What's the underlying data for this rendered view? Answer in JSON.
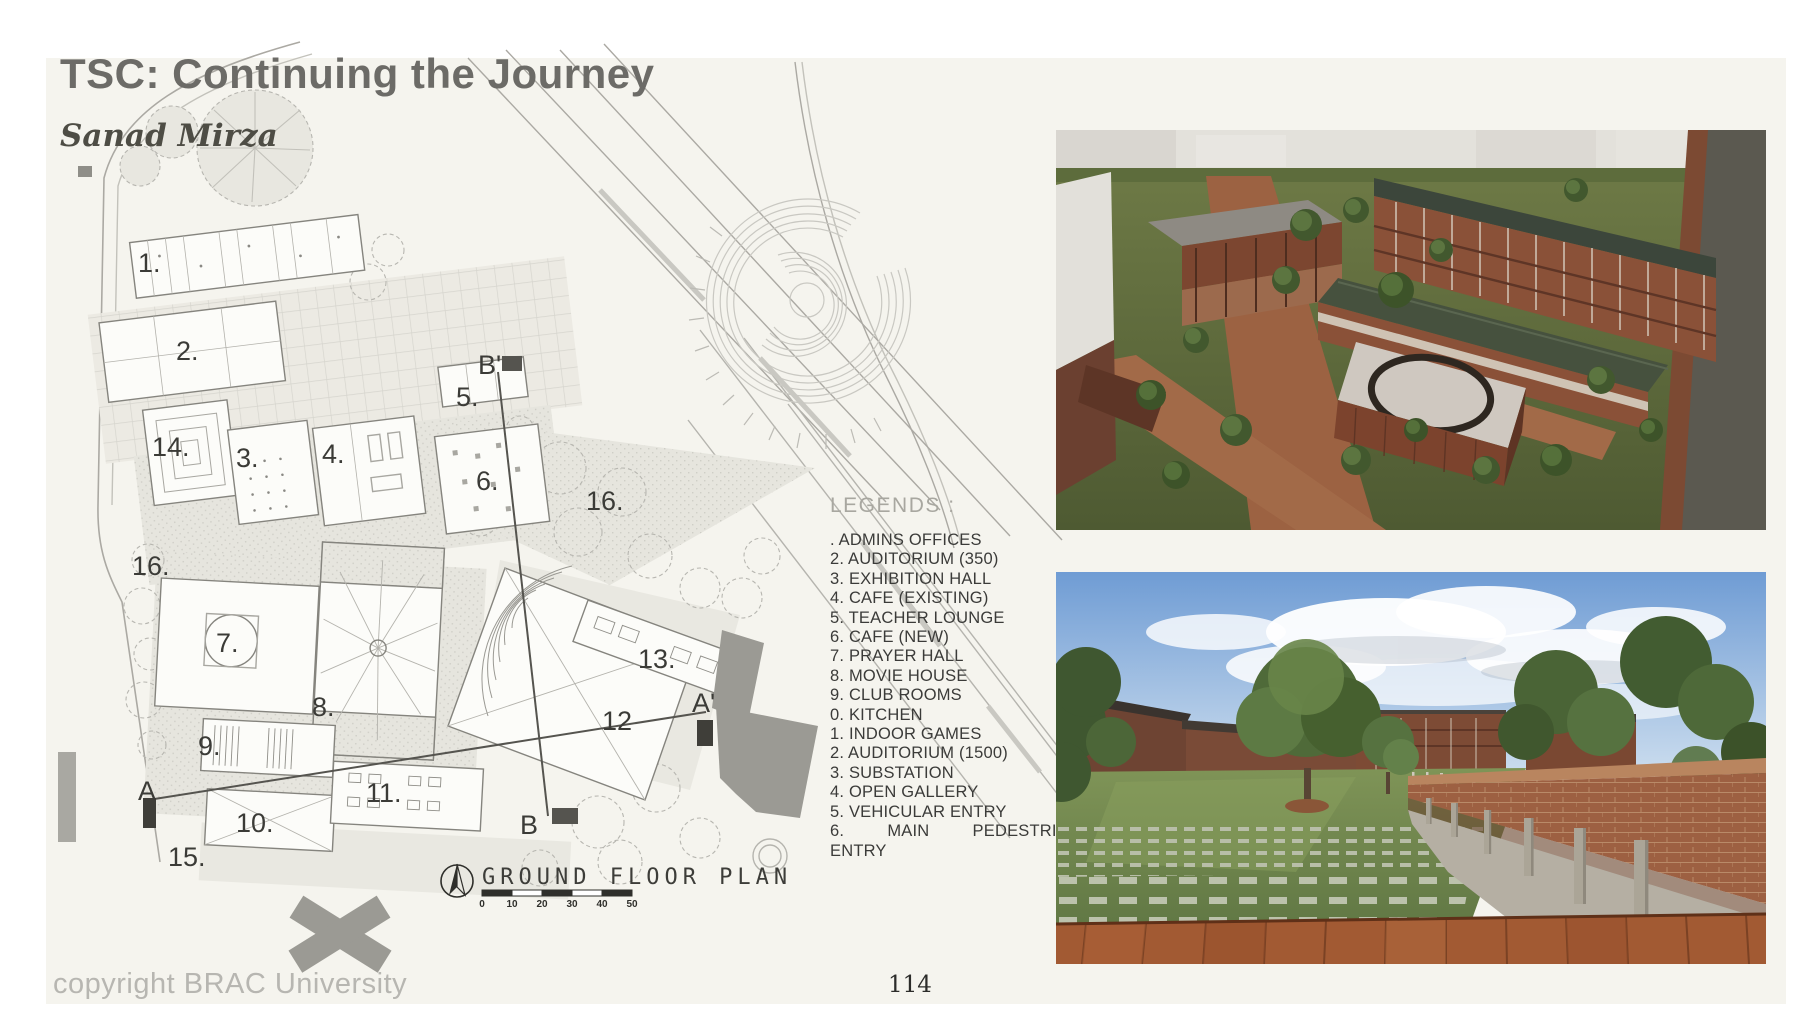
{
  "header": {
    "title": "TSC: Continuing the Journey",
    "subtitle": "Sanad Mirza"
  },
  "legends": {
    "title": "LEGENDS :",
    "items": [
      ". ADMINS OFFICES",
      "2. AUDITORIUM (350)",
      "3. EXHIBITION HALL",
      "4. CAFE (EXISTING)",
      "5. TEACHER LOUNGE",
      "6. CAFE (NEW)",
      "7. PRAYER HALL",
      "8. MOVIE HOUSE",
      "9. CLUB ROOMS",
      "0. KITCHEN",
      "1. INDOOR GAMES",
      "2. AUDITORIUM (1500)",
      "3. SUBSTATION",
      "4. OPEN GALLERY",
      "5. VEHICULAR ENTRY",
      "6. MAIN PEDESTRIAN",
      "ENTRY"
    ]
  },
  "plan": {
    "caption": "GROUND FLOOR PLAN",
    "scale_labels": [
      "0",
      "10",
      "20",
      "30",
      "40",
      "50"
    ],
    "labels": [
      "1.",
      "2.",
      "3.",
      "4.",
      "5.",
      "6.",
      "7.",
      "8.",
      "9.",
      "10.",
      "11.",
      "12",
      "13.",
      "14.",
      "15.",
      "16.",
      "16.",
      "A",
      "A'",
      "B",
      "B'"
    ]
  },
  "footer": {
    "copyright": "copyright BRAC University",
    "page_number": "114"
  },
  "colors": {
    "slide_bg": "#f5f4ee",
    "title_text": "#6c6b67",
    "subtitle_text": "#4e4d45",
    "legend_title": "#a8a7a0",
    "legend_text": "#3b3b39",
    "plan_line": "#85847e",
    "section_line": "#55544f",
    "footer_text": "#b7b6b1",
    "render_brick": "#9c5f40",
    "render_grass": "#66713f",
    "render_sky": "#6f9cd4",
    "render_roof_green": "#46513e"
  }
}
